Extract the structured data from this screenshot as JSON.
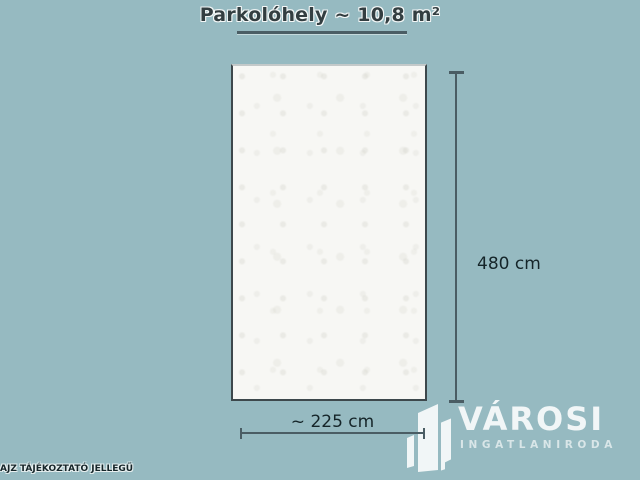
{
  "title": "Parkolóhely ~ 10,8 m²",
  "dimensions": {
    "height_label": "480 cm",
    "width_label": "~ 225 cm"
  },
  "disclaimer": "AJZ TÁJÉKOZTATÓ JELLEGŰ",
  "logo": {
    "name": "VÁROSI",
    "subtitle": "INGATLANIRODA",
    "icon": "buildings-icon"
  },
  "colors": {
    "background": "#96bac1",
    "room_fill": "#f7f7f4",
    "border": "#3d484c",
    "line": "#4a5d64",
    "text": "#152529",
    "title": "#333e41",
    "logo": "#f1f6f7"
  }
}
